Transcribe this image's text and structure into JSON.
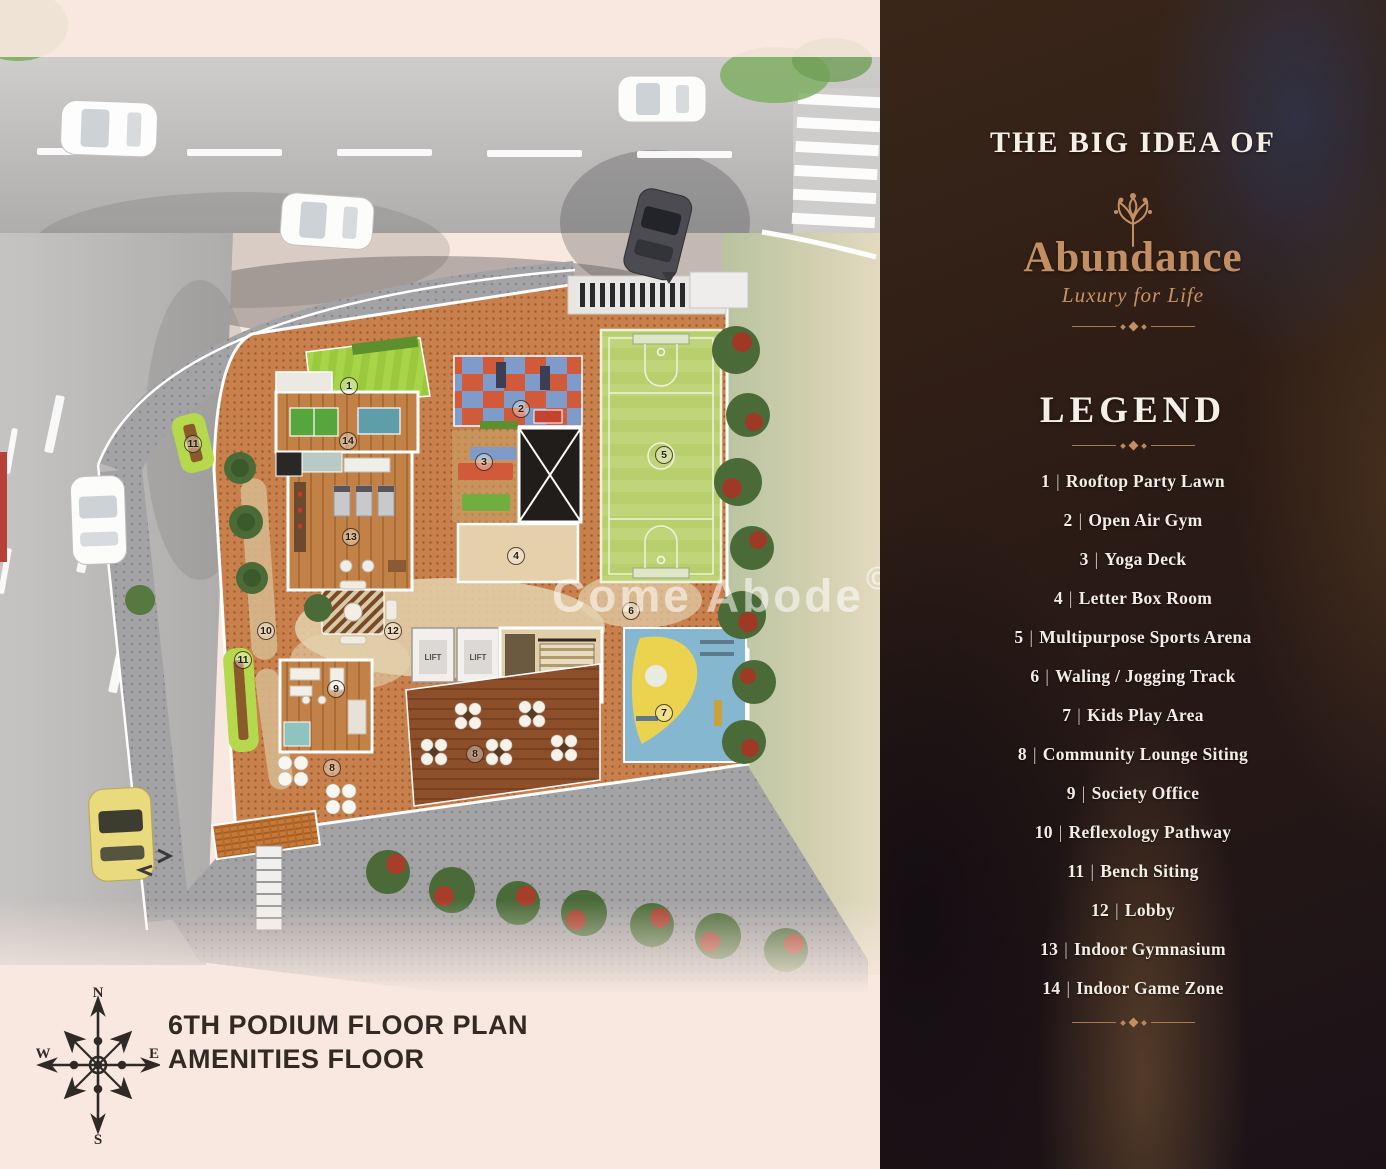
{
  "panel": {
    "heading": "THE BIG IDEA OF",
    "brand_name": "Abundance",
    "brand_tagline": "Luxury for Life",
    "legend_title": "LEGEND",
    "separator": "|",
    "legend_items": [
      {
        "num": "1",
        "label": "Rooftop Party Lawn"
      },
      {
        "num": "2",
        "label": "Open Air Gym"
      },
      {
        "num": "3",
        "label": "Yoga Deck"
      },
      {
        "num": "4",
        "label": "Letter Box Room"
      },
      {
        "num": "5",
        "label": "Multipurpose Sports Arena"
      },
      {
        "num": "6",
        "label": "Waling / Jogging Track"
      },
      {
        "num": "7",
        "label": "Kids Play Area"
      },
      {
        "num": "8",
        "label": "Community Lounge Siting"
      },
      {
        "num": "9",
        "label": "Society Office"
      },
      {
        "num": "10",
        "label": "Reflexology Pathway"
      },
      {
        "num": "11",
        "label": "Bench Siting"
      },
      {
        "num": "12",
        "label": "Lobby"
      },
      {
        "num": "13",
        "label": "Indoor Gymnasium"
      },
      {
        "num": "14",
        "label": "Indoor Game Zone"
      }
    ]
  },
  "plan": {
    "title_line1": "6TH PODIUM FLOOR PLAN",
    "title_line2": "AMENITIES FLOOR",
    "watermark": "Come Abode",
    "watermark_symbol": "©",
    "lift_label": "LIFT",
    "compass": {
      "n": "N",
      "e": "E",
      "s": "S",
      "w": "W"
    },
    "markers": [
      {
        "label": "1",
        "x": 349,
        "y": 386
      },
      {
        "label": "2",
        "x": 521,
        "y": 409
      },
      {
        "label": "3",
        "x": 484,
        "y": 462
      },
      {
        "label": "4",
        "x": 516,
        "y": 556
      },
      {
        "label": "5",
        "x": 664,
        "y": 455
      },
      {
        "label": "6",
        "x": 631,
        "y": 611
      },
      {
        "label": "7",
        "x": 664,
        "y": 713
      },
      {
        "label": "8",
        "x": 332,
        "y": 768
      },
      {
        "label": "8",
        "x": 475,
        "y": 754
      },
      {
        "label": "9",
        "x": 336,
        "y": 689
      },
      {
        "label": "10",
        "x": 266,
        "y": 631
      },
      {
        "label": "11",
        "x": 193,
        "y": 444
      },
      {
        "label": "11",
        "x": 243,
        "y": 660
      },
      {
        "label": "12",
        "x": 393,
        "y": 631
      },
      {
        "label": "13",
        "x": 351,
        "y": 537
      },
      {
        "label": "14",
        "x": 348,
        "y": 441
      }
    ],
    "colors": {
      "accent_copper": "#c48e63",
      "panel_background": "#2b1b15",
      "legend_text": "#f3ede3",
      "deck_terracotta": "#c8804c",
      "lawn_green": "#9ac93e",
      "title_text": "#332a24",
      "background_pink": "#f8e8df"
    }
  }
}
